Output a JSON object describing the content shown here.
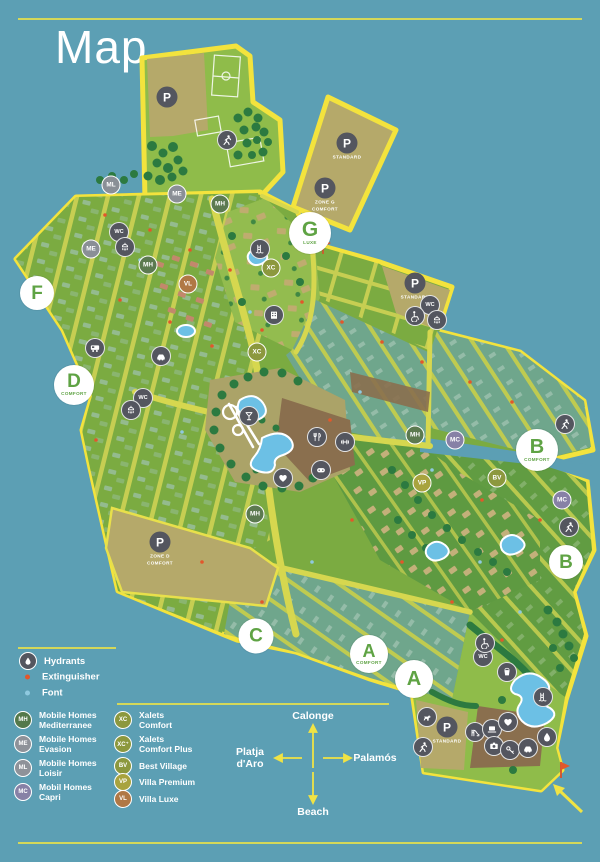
{
  "title": "Map",
  "colors": {
    "water": "#5C9FB4",
    "outline_yellow": "#F3E33D",
    "road": "#D6D74F",
    "parcel_green": "#7BAB41",
    "parcel_teal": "#6FA68C",
    "parking_tan": "#B5A96A",
    "tree_green": "#2C7A40",
    "pool_blue": "#6CC0E5",
    "badge_dark": "#54565F",
    "zone_letter_green": "#5FA344",
    "extinguisher_red": "#E2572B",
    "font_blue": "#8FC9DF",
    "badge": {
      "MH": "#5C7A50",
      "ME": "#8A8F96",
      "ML": "#8A8F96",
      "MC": "#8781A6",
      "XC": "#8C983E",
      "VP": "#A8A33E",
      "BV": "#8C983E",
      "VL": "#B07845"
    }
  },
  "zones": [
    {
      "letter": "F",
      "sublabel": ""
    },
    {
      "letter": "D",
      "sublabel": "COMFORT"
    },
    {
      "letter": "G",
      "sublabel": "LUXE"
    },
    {
      "letter": "B",
      "sublabel": "COMFORT"
    },
    {
      "letter": "B",
      "sublabel": ""
    },
    {
      "letter": "C",
      "sublabel": ""
    },
    {
      "letter": "A",
      "sublabel": "COMFORT"
    },
    {
      "letter": "A",
      "sublabel": ""
    }
  ],
  "parkings": [
    {
      "label": "P",
      "sublabel": ""
    },
    {
      "label": "P",
      "sublabel": "STANDARD"
    },
    {
      "label": "P",
      "sublabel": "ZONE G COMFORT"
    },
    {
      "label": "P",
      "sublabel": "ZONE D COMFORT"
    },
    {
      "label": "P",
      "sublabel": "STANDARD"
    },
    {
      "label": "P",
      "sublabel": "STANDARD"
    }
  ],
  "labels": {
    "wc": "WC"
  },
  "type_codes": {
    "ML": "ML",
    "ME": "ME",
    "MH": "MH",
    "MC": "MC",
    "VL": "VL",
    "XC": "XC",
    "VP": "VP",
    "BV": "BV"
  },
  "legend": {
    "markers": [
      {
        "label": "Hydrants"
      },
      {
        "label": "Extinguisher"
      },
      {
        "label": "Font"
      }
    ],
    "accommodations": [
      {
        "code": "MH",
        "line1": "Mobile Homes",
        "line2": "Mediterranee",
        "color": "#53784A"
      },
      {
        "code": "ME",
        "line1": "Mobile Homes",
        "line2": "Evasion",
        "color": "#8E9299"
      },
      {
        "code": "ML",
        "line1": "Mobile Homes",
        "line2": "Loisir",
        "color": "#8E9299"
      },
      {
        "code": "MC",
        "line1": "Mobil Homes",
        "line2": "Capri",
        "color": "#8781A6"
      },
      {
        "code": "XC",
        "line1": "Xalets",
        "line2": "Comfort",
        "color": "#8C983E"
      },
      {
        "code": "XC⁺",
        "line1": "Xalets",
        "line2": "Comfort Plus",
        "color": "#8C983E"
      },
      {
        "code": "BV",
        "line1": "Best Village",
        "line2": "",
        "color": "#8C983E"
      },
      {
        "code": "VP",
        "line1": "Villa Premium",
        "line2": "",
        "color": "#A8A33E"
      },
      {
        "code": "VL",
        "line1": "Villa Luxe",
        "line2": "",
        "color": "#B07845"
      }
    ]
  },
  "compass": {
    "north": "Calonge",
    "south": "Beach",
    "east": "Palamós",
    "west": "Platja d'Aro"
  }
}
